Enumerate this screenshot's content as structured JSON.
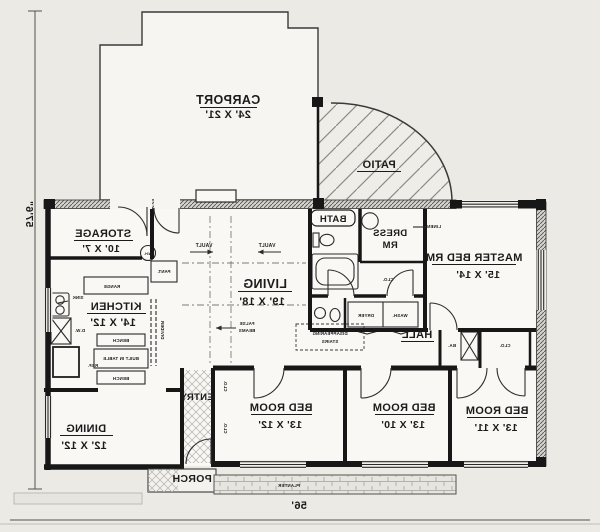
{
  "colors": {
    "ink": "#1b1b1b",
    "paper": "#eceae5",
    "room_fill": "#f9f8f5"
  },
  "dimensions": {
    "height": "57'6\"",
    "width": "56'"
  },
  "rooms": {
    "carport": {
      "name": "CARPORT",
      "size": "24' X 21'"
    },
    "patio": {
      "name": "PATIO"
    },
    "storage": {
      "name": "STORAGE",
      "size": "10' X 7'"
    },
    "kitchen": {
      "name": "KITCHEN",
      "size": "14' X 12'"
    },
    "living": {
      "name": "LIVING",
      "size": "19' X 18'"
    },
    "bath": {
      "name": "BATH"
    },
    "dress": {
      "line1": "DRESS",
      "line2": "RM"
    },
    "master": {
      "name": "MASTER BED RM",
      "size": "15' X 14'"
    },
    "hall": {
      "name": "HALL"
    },
    "dining": {
      "name": "DINING",
      "size": "12' X 12'"
    },
    "entry": {
      "name": "ENTRY"
    },
    "bed1": {
      "name": "BED ROOM",
      "size": "13' X 12'"
    },
    "bed2": {
      "name": "BED ROOM",
      "size": "13' X 10'"
    },
    "bed3": {
      "name": "BED ROOM",
      "size": "13' X 11'"
    },
    "porch": {
      "name": "PORCH"
    }
  },
  "annotations": {
    "vault": "VAULT",
    "false_beams_1": "FALSE",
    "false_beams_2": "BEAMS",
    "disappearing_1": "DISAPPEARING",
    "disappearing_2": "STAIRS",
    "divider": "DIVIDER",
    "range": "RANGE",
    "sink": "SINK",
    "dishwasher": "D.W.",
    "refrigerator": "REF.",
    "bench": "BENCH",
    "built_in_table": "BUILT IN TABLE",
    "pantry": "PANT.",
    "water_heater": "W.H.",
    "dryer": "DRYER",
    "washer": "WASH.",
    "closet": "CLO.",
    "linen": "LINEN",
    "bath_abbr": "BA.",
    "planter": "PLANTER"
  }
}
